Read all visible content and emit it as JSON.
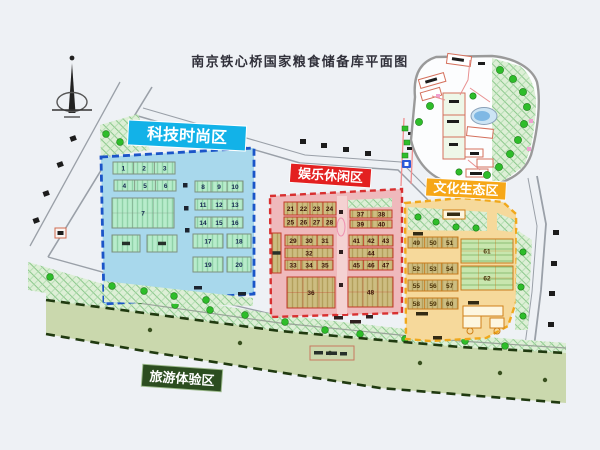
{
  "title": "南京铁心桥国家粮食储备库平面图",
  "zones": {
    "tech": {
      "label": "科技时尚区",
      "label_bg": "#12b2e8",
      "fill": "#a8d8ec",
      "border": "#1b55c8",
      "numbers": [
        "1",
        "2",
        "3",
        "4",
        "5",
        "6",
        "7",
        "8",
        "9",
        "10",
        "11",
        "12",
        "13",
        "14",
        "15",
        "16",
        "17",
        "18",
        "19",
        "20"
      ]
    },
    "leisure": {
      "label": "娱乐休闲区",
      "label_bg": "#e32020",
      "fill": "#efb9bc",
      "border": "#d83030",
      "numbers": [
        "21",
        "22",
        "23",
        "24",
        "25",
        "26",
        "27",
        "28",
        "29",
        "30",
        "31",
        "32",
        "33",
        "34",
        "35",
        "36",
        "37",
        "38",
        "39",
        "40",
        "41",
        "42",
        "43",
        "44",
        "45",
        "46",
        "47",
        "48"
      ]
    },
    "culture": {
      "label": "文化生态区",
      "label_bg": "#f6a718",
      "fill": "#f6d99b",
      "border": "#f0a81c",
      "numbers": [
        "49",
        "50",
        "51",
        "52",
        "53",
        "54",
        "55",
        "56",
        "57",
        "58",
        "59",
        "60",
        "61",
        "62"
      ]
    },
    "tourism": {
      "label": "旅游体验区",
      "label_bg": "#2c4d20",
      "fill": "#cad8ad",
      "border": "#2a3d14",
      "numbers": []
    }
  }
}
